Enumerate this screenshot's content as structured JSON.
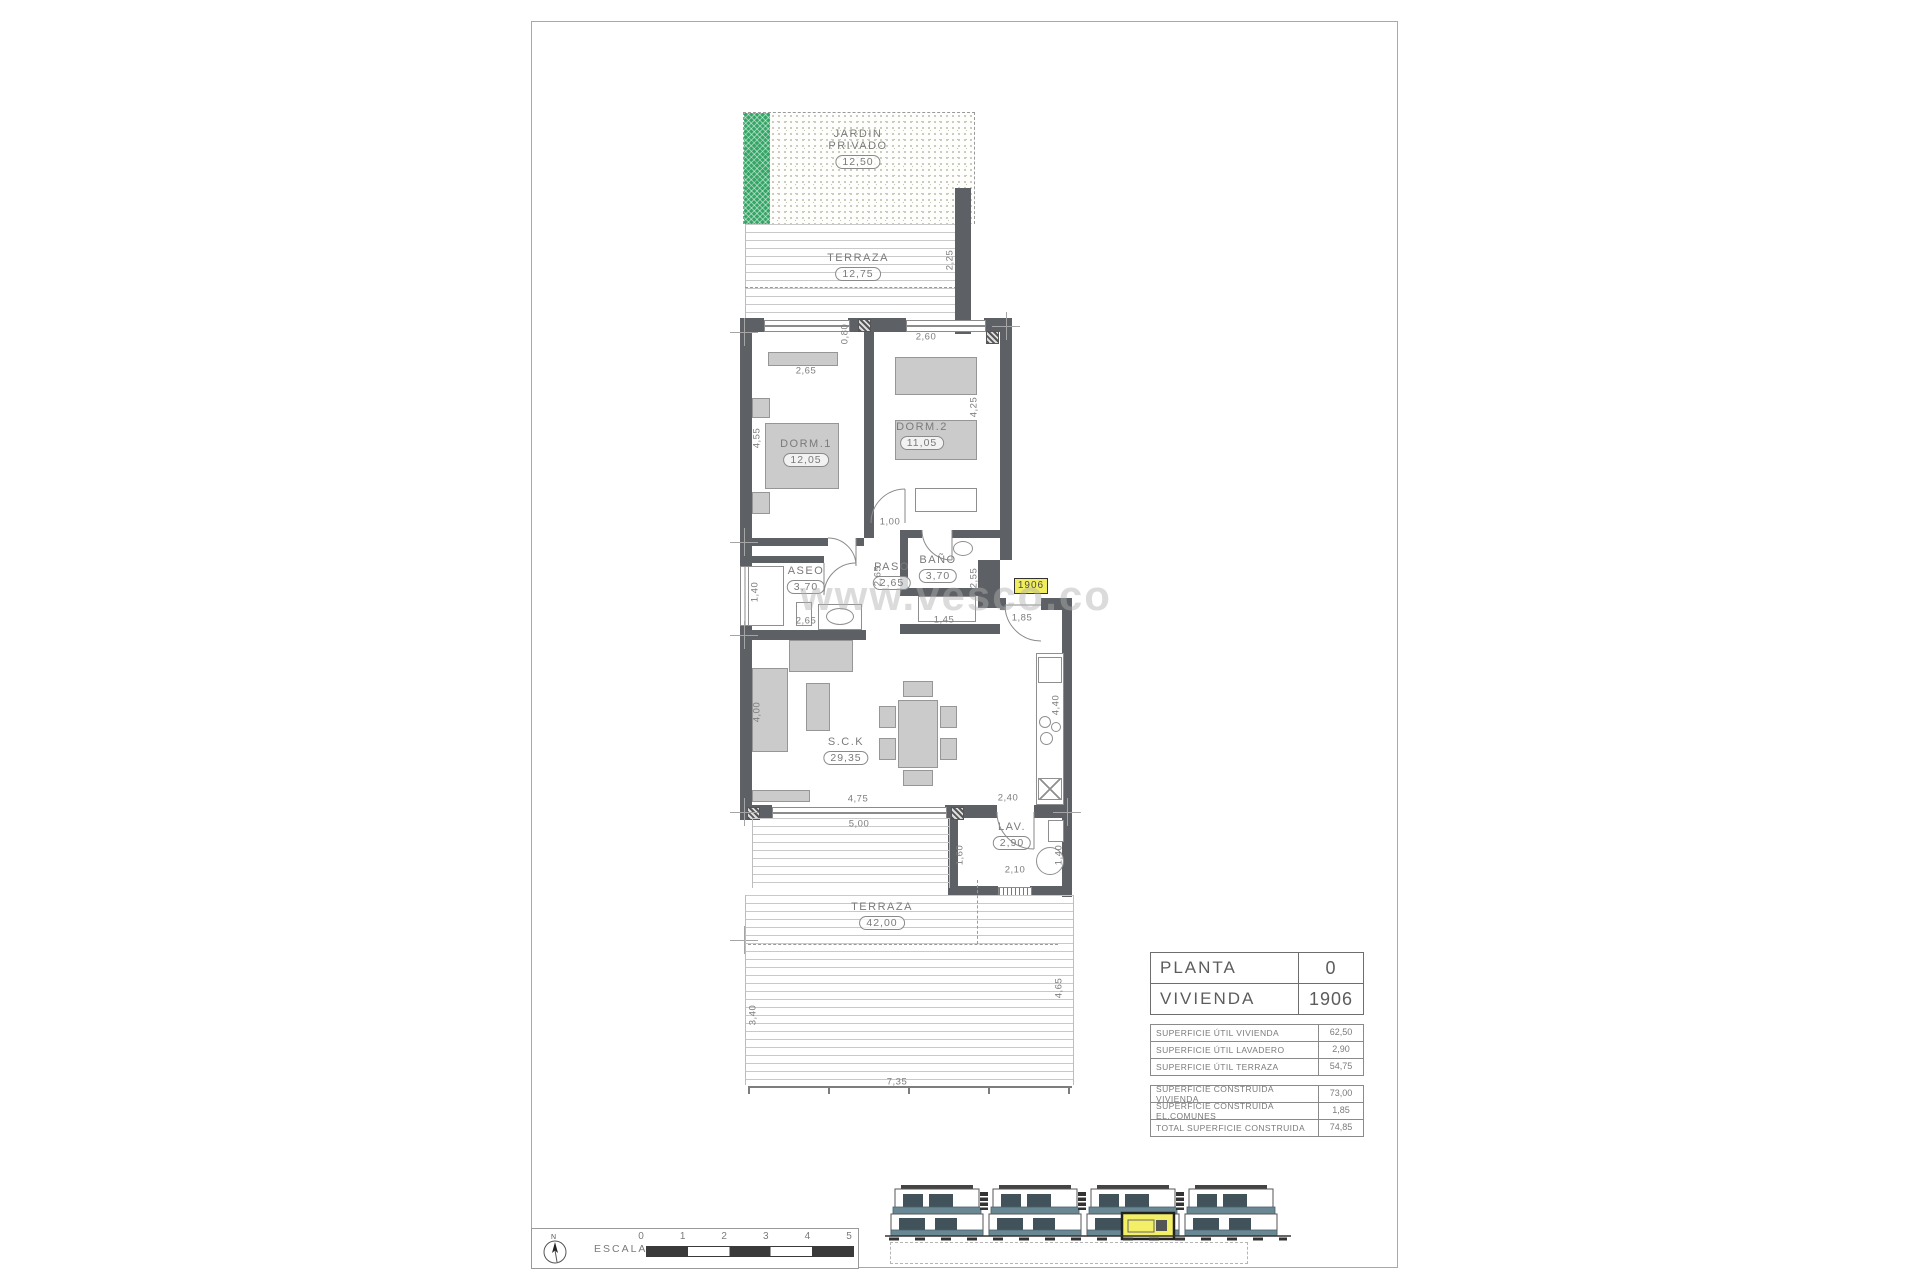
{
  "page": {
    "watermark": "www.vesco.co"
  },
  "plan": {
    "unit_tag": "1906",
    "rooms": {
      "jardin": {
        "name_line1": "JARDIN",
        "name_line2": "PRIVADO",
        "area": "12,50"
      },
      "terraza_top": {
        "name": "TERRAZA",
        "area": "12,75"
      },
      "dorm1": {
        "name": "DORM.1",
        "area": "12,05"
      },
      "dorm2": {
        "name": "DORM.2",
        "area": "11,05"
      },
      "aseo": {
        "name": "ASEO",
        "area": "3,70"
      },
      "paso": {
        "name": "PASO",
        "area": "2,65"
      },
      "bano": {
        "name": "BAÑO",
        "area": "3,70"
      },
      "sck": {
        "name": "S.C.K",
        "area": "29,35"
      },
      "lav": {
        "name": "LAV.",
        "area": "2,90"
      },
      "terraza_bottom": {
        "name": "TERRAZA",
        "area": "42,00"
      }
    },
    "dimensions": [
      {
        "text": "2,65",
        "x": 806,
        "y": 371
      },
      {
        "text": "2,60",
        "x": 926,
        "y": 337
      },
      {
        "text": "0,80",
        "x": 845,
        "y": 334,
        "rot": 1
      },
      {
        "text": "2,25",
        "x": 950,
        "y": 260,
        "rot": 1
      },
      {
        "text": "4,55",
        "x": 757,
        "y": 438,
        "rot": 1
      },
      {
        "text": "4,25",
        "x": 974,
        "y": 407,
        "rot": 1
      },
      {
        "text": "1,00",
        "x": 890,
        "y": 522
      },
      {
        "text": "2,65",
        "x": 878,
        "y": 576,
        "rot": 1
      },
      {
        "text": "1,40",
        "x": 755,
        "y": 592,
        "rot": 1
      },
      {
        "text": "2,65",
        "x": 806,
        "y": 621
      },
      {
        "text": "2,55",
        "x": 974,
        "y": 578,
        "rot": 1
      },
      {
        "text": "1,45",
        "x": 944,
        "y": 620
      },
      {
        "text": "1,85",
        "x": 1022,
        "y": 618
      },
      {
        "text": "4,00",
        "x": 757,
        "y": 712,
        "rot": 1
      },
      {
        "text": "4,75",
        "x": 858,
        "y": 799
      },
      {
        "text": "5,00",
        "x": 859,
        "y": 824
      },
      {
        "text": "4,40",
        "x": 1056,
        "y": 705,
        "rot": 1
      },
      {
        "text": "2,40",
        "x": 1008,
        "y": 798
      },
      {
        "text": "1,60",
        "x": 960,
        "y": 855,
        "rot": 1
      },
      {
        "text": "2,10",
        "x": 1015,
        "y": 870
      },
      {
        "text": "1,40",
        "x": 1059,
        "y": 855,
        "rot": 1
      },
      {
        "text": "3,40",
        "x": 753,
        "y": 1015,
        "rot": 1
      },
      {
        "text": "4,65",
        "x": 1059,
        "y": 988,
        "rot": 1
      },
      {
        "text": "7,35",
        "x": 897,
        "y": 1082
      }
    ]
  },
  "title_block": {
    "main_rows": [
      {
        "label": "PLANTA",
        "value": "0"
      },
      {
        "label": "VIVIENDA",
        "value": "1906"
      }
    ],
    "util_rows": [
      {
        "label": "SUPERFICIE ÚTIL VIVIENDA",
        "value": "62,50"
      },
      {
        "label": "SUPERFICIE ÚTIL LAVADERO",
        "value": "2,90"
      },
      {
        "label": "SUPERFICIE ÚTIL TERRAZA",
        "value": "54,75"
      }
    ],
    "built_rows": [
      {
        "label": "SUPERFICIE CONSTRUIDA VIVIENDA",
        "value": "73,00"
      },
      {
        "label": "SUPERFICIE CONSTRUIDA EL.COMUNES",
        "value": "1,85"
      },
      {
        "label": "TOTAL SUPERFICIE CONSTRUIDA",
        "value": "74,85"
      }
    ]
  },
  "scale_bar": {
    "label": "ESCALA :",
    "north": "N",
    "ticks": [
      "0",
      "1",
      "2",
      "3",
      "4",
      "5"
    ]
  },
  "colors": {
    "wall": "#5d6165",
    "garden_green": "#35a566",
    "elevation_teal": "#6a8894",
    "highlight_yellow": "#f3ef66"
  }
}
